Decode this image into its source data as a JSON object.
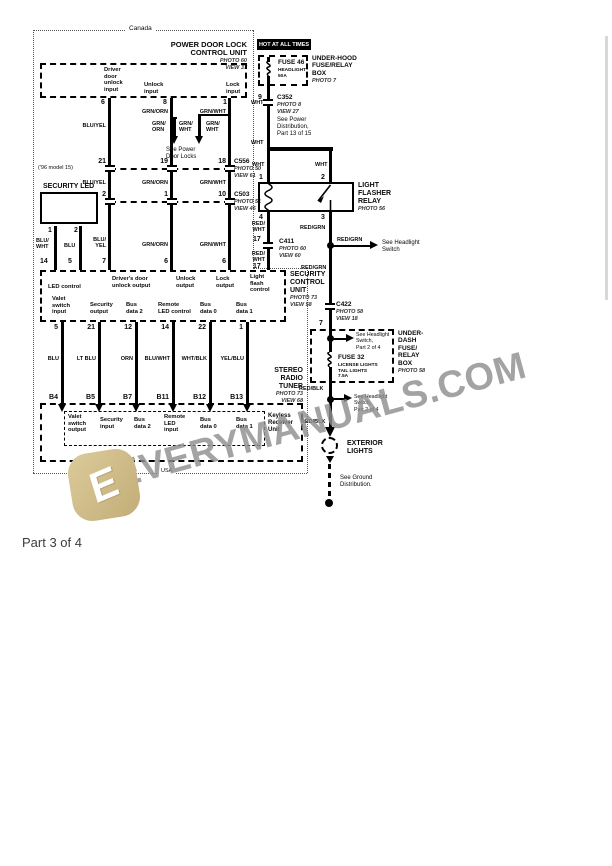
{
  "footer": "Part 3 of 4",
  "region": {
    "top": "Canada",
    "bottom": "USA"
  },
  "banner": "HOT AT ALL TIMES",
  "watermark": {
    "text": "EVERYMANUALS.COM",
    "logo_letter": "E"
  },
  "pdl": {
    "title": "POWER DOOR LOCK\nCONTROL UNIT",
    "ann": "PHOTO 60\nVIEW 37",
    "input_driver": "Driver\ndoor\nunlock\ninput",
    "input_unlock": "Unlock\ninput",
    "input_lock": "Lock\ninput"
  },
  "see": {
    "power_door_locks": "See Power\nDoor Locks",
    "power_distribution": "See Power\nDistribution,\nPart 13 of 15",
    "headlight_switch": "See Headlight\nSwitch",
    "headlight_switch_p2a": "See Headlight\nSwitch,\nPart 2 of 4",
    "headlight_switch_p2b": "See Headlight\nSwitch,\nPart 2 of 4",
    "ground_distribution": "See Ground\nDistribution."
  },
  "notes": {
    "model96": "('96 model 15)"
  },
  "pins": {
    "p6": "6",
    "p8": "8",
    "p1": "1",
    "p21": "21",
    "p19": "19",
    "p18": "18",
    "p2": "2",
    "p1b": "1",
    "p10": "10",
    "p7": "7",
    "p6b": "6",
    "p6c": "6",
    "led1": "1",
    "led2": "2",
    "p14": "14",
    "p5": "5",
    "p9": "9",
    "r1": "1",
    "r2": "2",
    "r4": "4",
    "r3": "3",
    "p17a": "17",
    "p17b": "17",
    "p7r": "7",
    "s5": "5",
    "s21": "21",
    "s12": "12",
    "s14": "14",
    "s22": "22",
    "s1": "1",
    "b4": "B4",
    "b5": "B5",
    "b7": "B7",
    "b11": "B11",
    "b12": "B12",
    "b13": "B13"
  },
  "colors": {
    "wa1": "BLU/YEL",
    "wa2": "BLU/YEL",
    "wa3": "BLU/\nYEL",
    "wb1": "GRN/ORN",
    "wb2": "GRN/ORN",
    "wb3": "GRN/ORN",
    "wc1": "GRN/WHT",
    "wc2": "GRN/WHT",
    "wc3": "GRN/WHT",
    "br1": "GRN/\nORN",
    "br2": "GRN/\nWHT",
    "br3": "GRN/\nWHT",
    "led_l": "BLU/\nWHT",
    "led_r": "BLU",
    "wht1": "WHT",
    "wht2": "WHT",
    "wht3": "WHT",
    "wht4": "WHT",
    "rw1": "RED/\nWHT",
    "rw2": "RED/\nWHT",
    "rg1": "RED/GRN",
    "rg2": "RED/GRN",
    "rg3": "RED/GRN",
    "rb1": "RED/BLK",
    "rb2": "RED/BLK",
    "t1": "BLU",
    "t2": "LT BLU",
    "t3": "ORN",
    "t4": "BLU/WHT",
    "t5": "WHT/BLK",
    "t6": "YEL/BLU"
  },
  "connectors": {
    "c556": "C556",
    "c556_ann": "PHOTO 50\nVIEW 61",
    "c503": "C503",
    "c503_ann": "PHOTO 51\nVIEW 46",
    "c352": "C352",
    "c352_ann": "PHOTO 8\nVIEW 27",
    "c411": "C411",
    "c411_ann": "PHOTO 60\nVIEW 60",
    "c422": "C422",
    "c422_ann": "PHOTO 58\nVIEW 18"
  },
  "security_led": {
    "title": "SECURITY LED"
  },
  "scu": {
    "title": "SECURITY\nCONTROL\nUNIT",
    "ann": "PHOTO 73\nVIEW 58",
    "led_control": "LED control",
    "driver_unlock": "Driver's door\nunlock output",
    "unlock": "Unlock\noutput",
    "lock": "Lock\noutput",
    "flash": "Light\nflash\ncontrol",
    "valet": "Valet\nswitch\ninput",
    "security": "Security\noutput",
    "bus2": "Bus\ndata 2",
    "remote": "Remote\nLED control",
    "bus0": "Bus\ndata 0",
    "bus1": "Bus\ndata 1"
  },
  "tuner": {
    "title": "STEREO\nRADIO\nTUNER",
    "ann": "PHOTO 73\nVIEW 68",
    "valet": "Valet\nswitch\noutput",
    "security": "Security\ninput",
    "bus2": "Bus\ndata 2",
    "remote": "Remote\nLED\ninput",
    "bus0": "Bus\ndata 0",
    "bus1": "Bus\ndata 1",
    "keyless": "Keyless\nReceiver\nUnit"
  },
  "underhood": {
    "title": "UNDER-HOOD\nFUSE/RELAY\nBOX",
    "ann": "PHOTO 7",
    "fuse": "FUSE 46",
    "fuse_sub": "HEADLIGHT\n50A"
  },
  "relay": {
    "title": "LIGHT\nFLASHER\nRELAY",
    "ann": "PHOTO 56"
  },
  "underdash": {
    "title": "UNDER-\nDASH\nFUSE/\nRELAY\nBOX",
    "ann": "PHOTO 58",
    "fuse": "FUSE 32",
    "fuse_sub": "LICENSE LIGHTS\nTAIL LIGHTS\n7.5A"
  },
  "exterior": {
    "title": "EXTERIOR\nLIGHTS"
  }
}
